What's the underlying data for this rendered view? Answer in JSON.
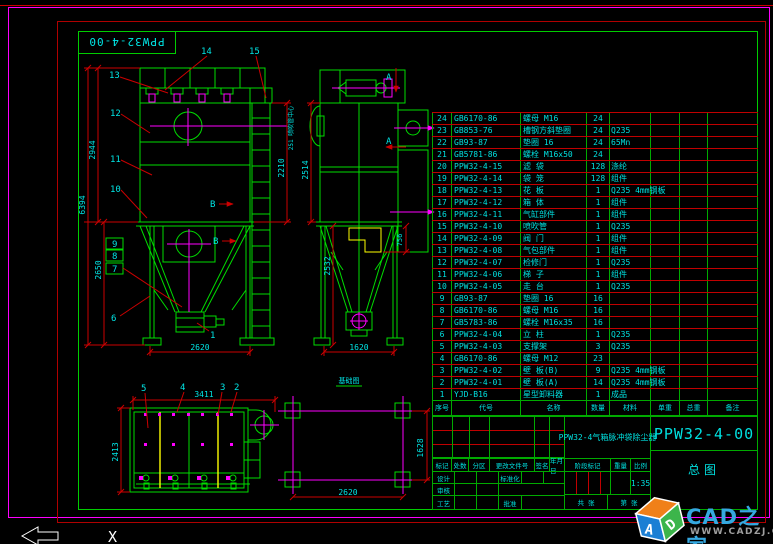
{
  "corner_box": {
    "drawing_no": "PPW32-4-00"
  },
  "colors": {
    "line_green": "#00dd00",
    "dim_red": "#cc0000",
    "text_cyan": "#00e5e5",
    "centerline_magenta": "#ff00ff",
    "detail_yellow": "#ffff00",
    "border_magenta": "#ff00ff",
    "brand_blue": "#35a8e0"
  },
  "views": {
    "front": {
      "c14": "14",
      "c15": "15",
      "c13": "13",
      "c12": "12",
      "c11": "11",
      "c10": "10",
      "c9": "9",
      "c8": "8",
      "c7": "7",
      "c6": "6",
      "c1": "1",
      "section": "B",
      "dims": {
        "total": "6394",
        "body": "2944",
        "hopper": "2650",
        "right": "2210",
        "width": "2620"
      }
    },
    "side": {
      "section": "A",
      "note": "251 喷吹管中心",
      "dims": {
        "body": "2514",
        "lower": "2532",
        "inlet": "756",
        "width": "1620"
      }
    },
    "plan": {
      "c5": "5",
      "c4": "4",
      "c3": "3",
      "c2": "2",
      "dims": {
        "width": "3411",
        "depth": "2413"
      }
    },
    "foundation": {
      "label": "基础图",
      "dims": {
        "width": "2620",
        "depth": "1628"
      }
    }
  },
  "table": {
    "headers": [
      "序号",
      "代号",
      "名称",
      "数量",
      "材料",
      "单重",
      "总重",
      "备注"
    ],
    "rows": [
      {
        "no": "24",
        "code": "GB6170-86",
        "name": "螺母 M16",
        "qty": "24",
        "mat": ""
      },
      {
        "no": "23",
        "code": "GB853-76",
        "name": "槽钢方斜垫圈",
        "qty": "24",
        "mat": "Q235"
      },
      {
        "no": "22",
        "code": "GB93-87",
        "name": "垫圈 16",
        "qty": "24",
        "mat": "65Mn"
      },
      {
        "no": "21",
        "code": "GB5781-86",
        "name": "螺栓 M16x50",
        "qty": "24",
        "mat": ""
      },
      {
        "no": "20",
        "code": "PPW32-4-15",
        "name": "滤 袋",
        "qty": "128",
        "mat": "涤纶"
      },
      {
        "no": "19",
        "code": "PPW32-4-14",
        "name": "袋 笼",
        "qty": "128",
        "mat": "组件"
      },
      {
        "no": "18",
        "code": "PPW32-4-13",
        "name": "花 板",
        "qty": "1",
        "mat": "Q235 4mm钢板"
      },
      {
        "no": "17",
        "code": "PPW32-4-12",
        "name": "箱 体",
        "qty": "1",
        "mat": "组件"
      },
      {
        "no": "16",
        "code": "PPW32-4-11",
        "name": "气缸部件",
        "qty": "1",
        "mat": "组件"
      },
      {
        "no": "15",
        "code": "PPW32-4-10",
        "name": "喷吹管",
        "qty": "1",
        "mat": "Q235"
      },
      {
        "no": "14",
        "code": "PPW32-4-09",
        "name": "阀 门",
        "qty": "1",
        "mat": "组件"
      },
      {
        "no": "13",
        "code": "PPW32-4-08",
        "name": "气包部件",
        "qty": "1",
        "mat": "组件"
      },
      {
        "no": "12",
        "code": "PPW32-4-07",
        "name": "检修门",
        "qty": "1",
        "mat": "Q235"
      },
      {
        "no": "11",
        "code": "PPW32-4-06",
        "name": "梯 子",
        "qty": "1",
        "mat": "组件"
      },
      {
        "no": "10",
        "code": "PPW32-4-05",
        "name": "走 台",
        "qty": "1",
        "mat": "Q235"
      },
      {
        "no": "9",
        "code": "GB93-87",
        "name": "垫圈 16",
        "qty": "16",
        "mat": ""
      },
      {
        "no": "8",
        "code": "GB6170-86",
        "name": "螺母 M16",
        "qty": "16",
        "mat": ""
      },
      {
        "no": "7",
        "code": "GB5783-86",
        "name": "螺栓 M16x35",
        "qty": "16",
        "mat": ""
      },
      {
        "no": "6",
        "code": "PPW32-4-04",
        "name": "立 柱",
        "qty": "1",
        "mat": "Q235"
      },
      {
        "no": "5",
        "code": "PPW32-4-03",
        "name": "支撑架",
        "qty": "3",
        "mat": "Q235"
      },
      {
        "no": "4",
        "code": "GB6170-86",
        "name": "螺母 M12",
        "qty": "23",
        "mat": ""
      },
      {
        "no": "3",
        "code": "PPW32-4-02",
        "name": "壁 板(B)",
        "qty": "9",
        "mat": "Q235 4mm钢板"
      },
      {
        "no": "2",
        "code": "PPW32-4-01",
        "name": "壁 板(A)",
        "qty": "14",
        "mat": "Q235 4mm钢板"
      },
      {
        "no": "1",
        "code": "YJD-B16",
        "name": "星型卸料器",
        "qty": "1",
        "mat": "成品"
      }
    ]
  },
  "titleblock": {
    "product_title": "PPW32-4气箱脉冲袋除尘器",
    "drawing_no": "PPW32-4-00",
    "view_name": "总图",
    "stage_label": "阶段标记",
    "weight_label": "重量",
    "scale_label": "比例",
    "scale_value": "1:35",
    "sheet_total": "共 张",
    "sheet_no": "第 张",
    "rev_headers": [
      "标记",
      "处数",
      "分区",
      "更改文件号",
      "签名",
      "年月日"
    ],
    "sig_design": "设计",
    "sig_check": "审核",
    "sig_process": "工艺",
    "sig_std": "标准化",
    "sig_approve": "批准"
  },
  "ucs": {
    "axis": "X"
  },
  "watermark": {
    "brand": "CAD之家",
    "site": "WWW.CADZJ.COM",
    "cube_letters": [
      "A",
      "D"
    ]
  }
}
